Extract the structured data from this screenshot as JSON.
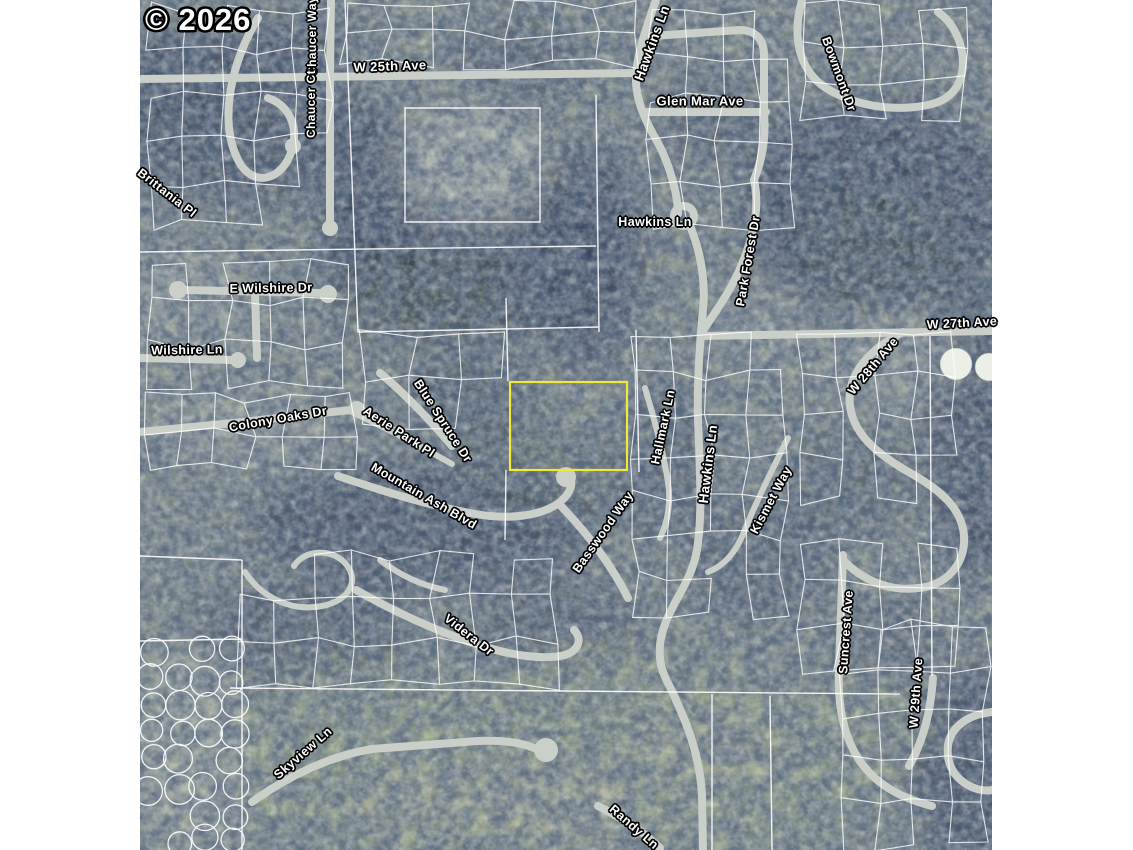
{
  "map": {
    "copyright_watermark": "© 2026",
    "highlighted_parcel": {
      "x": 510,
      "y": 382,
      "width": 117,
      "height": 88,
      "stroke_color": "#f2e838"
    },
    "label_style": {
      "text_color": "#ffffff",
      "halo_color": "#000000"
    },
    "street_labels": [
      {
        "id": "chaucer-way",
        "text": "Chaucer Way",
        "x": 312,
        "y": 36,
        "rot": -90,
        "fs": 12
      },
      {
        "id": "w-25th-ave",
        "text": "W 25th Ave",
        "x": 390,
        "y": 66,
        "rot": -2,
        "fs": 13
      },
      {
        "id": "chaucer-ct",
        "text": "Chaucer Ct",
        "x": 311,
        "y": 104,
        "rot": -90,
        "fs": 12
      },
      {
        "id": "hawkins-ln-north",
        "text": "Hawkins Ln",
        "x": 652,
        "y": 43,
        "rot": -70,
        "fs": 13.5
      },
      {
        "id": "glen-mar-ave",
        "text": "Glen Mar Ave",
        "x": 700,
        "y": 101,
        "rot": 0,
        "fs": 13
      },
      {
        "id": "bowmont-dr",
        "text": "Bowmont Dr",
        "x": 839,
        "y": 74,
        "rot": 70,
        "fs": 12.5
      },
      {
        "id": "brittania-pl",
        "text": "Brittania Pl",
        "x": 167,
        "y": 193,
        "rot": 38,
        "fs": 12.5
      },
      {
        "id": "e-wilshire-dr",
        "text": "E Wilshire Dr",
        "x": 271,
        "y": 288,
        "rot": -1,
        "fs": 12.5
      },
      {
        "id": "wilshire-ln",
        "text": "Wilshire Ln",
        "x": 187,
        "y": 350,
        "rot": -1,
        "fs": 12.5
      },
      {
        "id": "hawkins-ln-mid",
        "text": "Hawkins Ln",
        "x": 655,
        "y": 222,
        "rot": 0,
        "fs": 12.5
      },
      {
        "id": "park-forest-dr",
        "text": "Park Forest Dr",
        "x": 748,
        "y": 261,
        "rot": -80,
        "fs": 12.5
      },
      {
        "id": "w-27th-ave",
        "text": "W 27th Ave",
        "x": 962,
        "y": 323,
        "rot": -3,
        "fs": 12.5
      },
      {
        "id": "w-28th-ave",
        "text": "W 28th Ave",
        "x": 873,
        "y": 366,
        "rot": -50,
        "fs": 12.5
      },
      {
        "id": "colony-oaks-dr",
        "text": "Colony Oaks Dr",
        "x": 278,
        "y": 419,
        "rot": -10,
        "fs": 12.5
      },
      {
        "id": "aerie-park-pl",
        "text": "Aerie Park Pl",
        "x": 399,
        "y": 432,
        "rot": 33,
        "fs": 12.5
      },
      {
        "id": "blue-spruce-dr",
        "text": "Blue Spruce Dr",
        "x": 443,
        "y": 421,
        "rot": 57,
        "fs": 12.5
      },
      {
        "id": "mountain-ash-blvd",
        "text": "Mountain Ash Blvd",
        "x": 424,
        "y": 496,
        "rot": 30,
        "fs": 12.5
      },
      {
        "id": "hallmark-ln",
        "text": "Hallmark Ln",
        "x": 663,
        "y": 427,
        "rot": -78,
        "fs": 12.5
      },
      {
        "id": "hawkins-ln-center",
        "text": "Hawkins Ln",
        "x": 708,
        "y": 464,
        "rot": -83,
        "fs": 13.5
      },
      {
        "id": "kismet-way",
        "text": "Kismet Way",
        "x": 771,
        "y": 500,
        "rot": -62,
        "fs": 12.5
      },
      {
        "id": "basswood-way",
        "text": "Basswood Way",
        "x": 603,
        "y": 532,
        "rot": -55,
        "fs": 12.5
      },
      {
        "id": "suncrest-ave",
        "text": "Suncrest Ave",
        "x": 846,
        "y": 632,
        "rot": -86,
        "fs": 12.5
      },
      {
        "id": "videra-dr",
        "text": "Videra Dr",
        "x": 469,
        "y": 635,
        "rot": 38,
        "fs": 12.5
      },
      {
        "id": "skyview-ln",
        "text": "Skyview Ln",
        "x": 303,
        "y": 753,
        "rot": -41,
        "fs": 12.5
      },
      {
        "id": "w-29th-ave",
        "text": "W 29th Ave",
        "x": 916,
        "y": 693,
        "rot": -86,
        "fs": 12.5
      },
      {
        "id": "randy-ln",
        "text": "Randy Ln",
        "x": 634,
        "y": 827,
        "rot": 41,
        "fs": 12.5
      }
    ]
  }
}
